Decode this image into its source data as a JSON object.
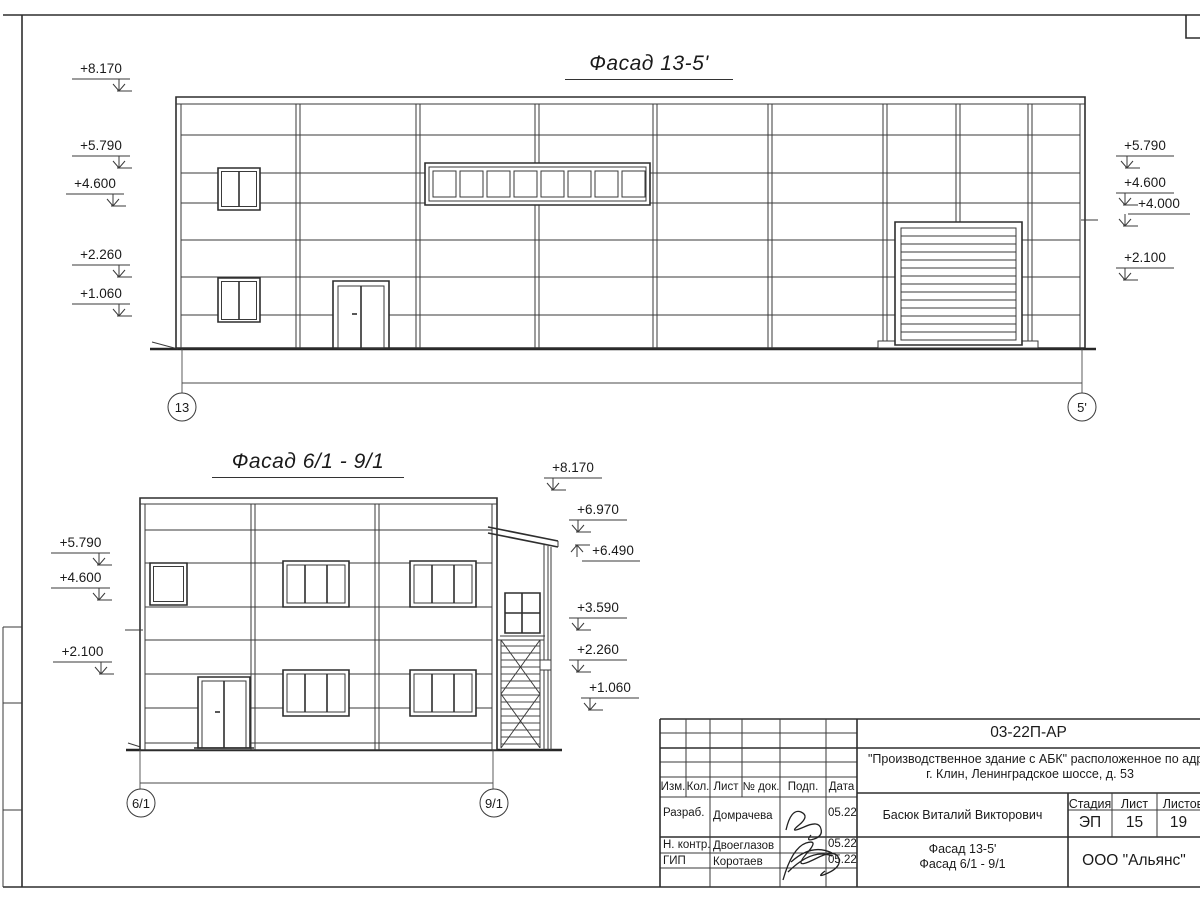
{
  "facade1": {
    "title": "Фасад 13-5'",
    "left_marks": [
      "+8.170",
      "+5.790",
      "+4.600",
      "+2.260",
      "+1.060"
    ],
    "right_marks": [
      "+5.790",
      "+4.600",
      "+4.000",
      "+2.100"
    ],
    "axis_left": "13",
    "axis_right": "5'"
  },
  "facade2": {
    "title": "Фасад 6/1 - 9/1",
    "left_marks": [
      "+5.790",
      "+4.600",
      "+2.100"
    ],
    "right_marks": [
      "+8.170",
      "+6.970",
      "+6.490",
      "+3.590",
      "+2.260",
      "+1.060"
    ],
    "axis_left": "6/1",
    "axis_right": "9/1"
  },
  "title_block": {
    "doc_code": "03-22П-АР",
    "project_name_line1": "\"Производственное здание с АБК\" расположенное по адресу:",
    "project_name_line2": "г. Клин, Ленинградское шоссе, д. 53",
    "header_cols": {
      "izm": "Изм.",
      "kol": "Кол.",
      "list": "Лист",
      "doc_no": "№ док.",
      "podp": "Подп.",
      "data": "Дата"
    },
    "signers": [
      {
        "role": "Разраб.",
        "name": "Домрачева",
        "date": "05.22"
      },
      {
        "role": "Н. контр.",
        "name": "Двоеглазов",
        "date": "05.22"
      },
      {
        "role": "ГИП",
        "name": "Коротаев",
        "date": "05.22"
      }
    ],
    "approver": "Басюк Виталий Викторович",
    "stage_label": "Стадия",
    "sheet_label": "Лист",
    "sheets_label": "Листов",
    "stage": "ЭП",
    "sheet_number": "15",
    "sheets_total": "19",
    "drawing_title_line1": "Фасад 13-5'",
    "drawing_title_line2": "Фасад 6/1 - 9/1",
    "company": "ООО \"Альянс\""
  }
}
